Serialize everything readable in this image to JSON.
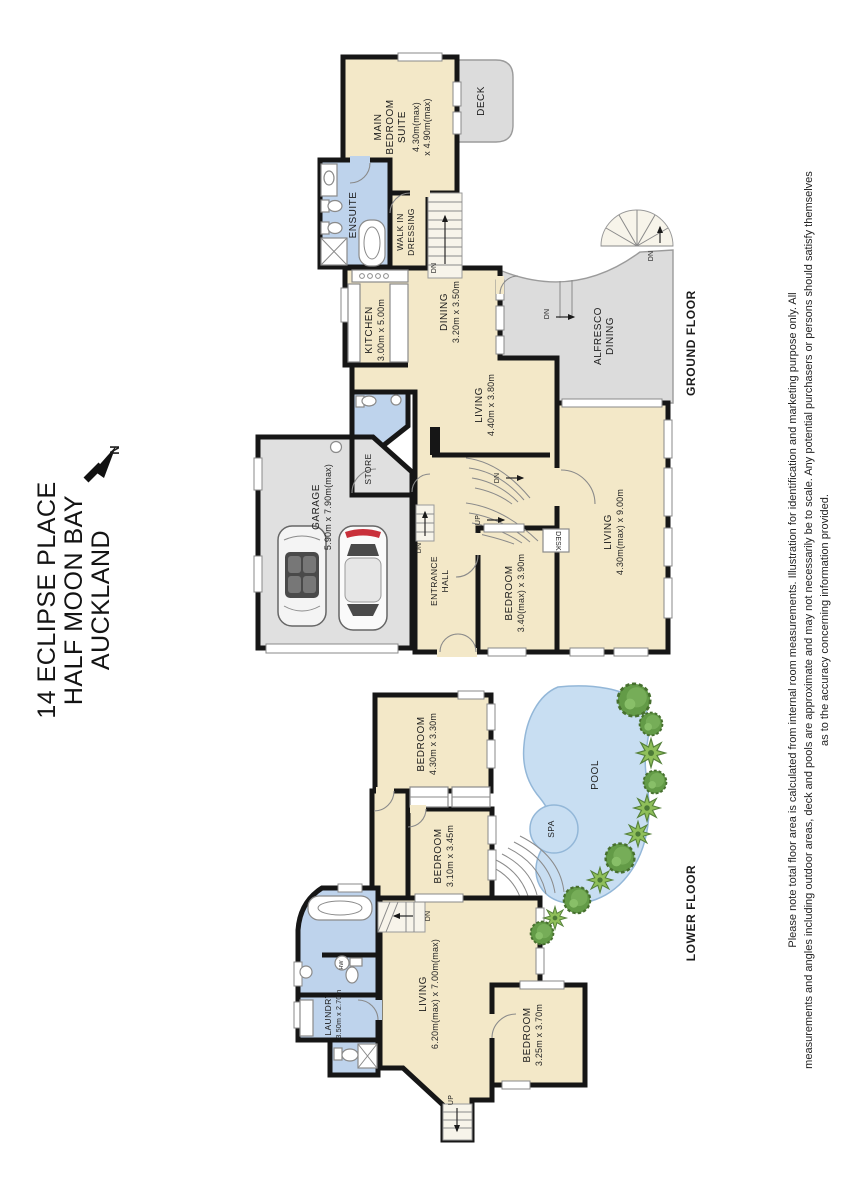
{
  "address": {
    "line1": "14 ECLIPSE PLACE",
    "line2": "HALF MOON BAY",
    "line3": "AUCKLAND"
  },
  "compass": {
    "north": "N"
  },
  "ground_floor": {
    "floor_label": "GROUND FLOOR",
    "main_bedroom": {
      "l1": "MAIN",
      "l2": "BEDROOM",
      "l3": "SUITE",
      "d1": "4.30m(max)",
      "d2": "x 4.90m(max)"
    },
    "deck": "DECK",
    "ensuite": "ENSUITE",
    "walk_in": {
      "l1": "WALK IN",
      "l2": "DRESSING"
    },
    "kitchen": {
      "name": "KITCHEN",
      "dims": "3.00m x 5.00m"
    },
    "dining": {
      "name": "DINING",
      "dims": "3.20m x 3.50m"
    },
    "alfresco": {
      "l1": "ALFRESCO",
      "l2": "DINING"
    },
    "living_main": {
      "name": "LIVING",
      "dims": "4.40m x 3.80m"
    },
    "garage": {
      "name": "GARAGE",
      "dims": "5.90m x 7.90m(max)"
    },
    "store": "STORE",
    "entrance": {
      "l1": "ENTRANCE",
      "l2": "HALL"
    },
    "bedroom": {
      "name": "BEDROOM",
      "dims": "3.40(max) x 3.90m"
    },
    "desk": "DESK",
    "living_big": {
      "name": "LIVING",
      "dims": "4.30m(max) x 9.00m"
    }
  },
  "lower_floor": {
    "floor_label": "LOWER FLOOR",
    "bedroom1": {
      "name": "BEDROOM",
      "dims": "4.30m x 3.30m"
    },
    "bedroom2": {
      "name": "BEDROOM",
      "dims": "3.10m x 3.45m"
    },
    "bedroom3": {
      "name": "BEDROOM",
      "dims": "3.25m x 3.70m"
    },
    "living": {
      "name": "LIVING",
      "dims": "6.20m(max) x 7.00m(max)"
    },
    "laundry": {
      "name": "LAUNDRY",
      "dims": "3.50m x 2.70m"
    },
    "pool": "POOL",
    "spa": "SPA"
  },
  "stairs": {
    "dn": "DN",
    "up": "UP",
    "hw": "HW"
  },
  "disclaimer": {
    "line1": "Please note total floor area is calculated from internal room measurements. Illustration for identification and marketing purpose only. All",
    "line2": "measurements and angles including outdoor areas, deck and pools are approximate and may not necessarily be to scale. Any potential purchasers or persons should satisfy themselves",
    "line3": "as to the accuracy concerning information provided."
  },
  "colors": {
    "room_beige": "#f3e8c8",
    "wet_area_blue": "#bed3ec",
    "outdoor_grey": "#dcdcdc",
    "pool_blue": "#c8def2",
    "wall_black": "#161616",
    "bush_green": "#68a04b"
  }
}
